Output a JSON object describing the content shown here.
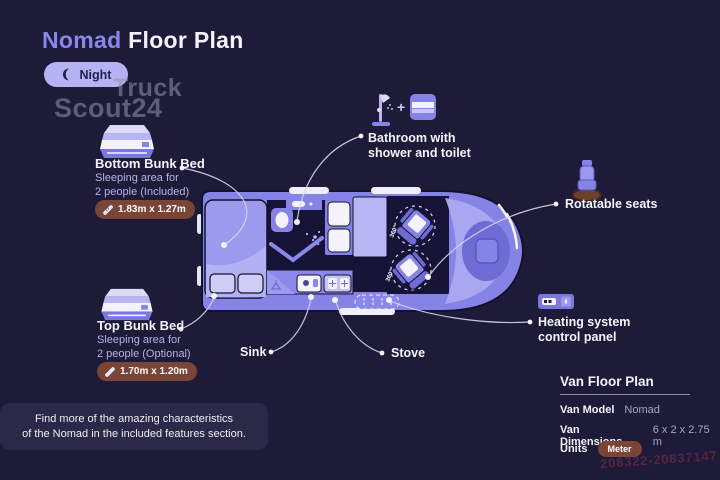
{
  "page": {
    "title_accent": "Nomad",
    "title_rest": "Floor Plan"
  },
  "mode_toggle": {
    "label": "Night"
  },
  "brand_watermark": {
    "line1": "Truck",
    "line2": "Scout24"
  },
  "callouts": {
    "bottom_bunk": {
      "title": "Bottom Bunk Bed",
      "subtitle1": "Sleeping area for",
      "subtitle2": "2 people (Included)",
      "dimensions": "1.83m x 1.27m"
    },
    "top_bunk": {
      "title": "Top Bunk Bed",
      "subtitle1": "Sleeping area for",
      "subtitle2": "2 people (Optional)",
      "dimensions": "1.70m x 1.20m"
    },
    "bathroom": {
      "label1": "Bathroom with",
      "label2": "shower and toilet",
      "plus": "+"
    },
    "rotatable_seats": {
      "label": "Rotatable seats"
    },
    "heating": {
      "label1": "Heating system",
      "label2": "control panel"
    },
    "sink": {
      "label": "Sink"
    },
    "stove": {
      "label": "Stove"
    }
  },
  "van_diagram": {
    "rotation_label": "360°"
  },
  "footer_note": {
    "line1": "Find more of the amazing characteristics",
    "line2": "of the Nomad in the included features section."
  },
  "spec_panel": {
    "title": "Van Floor Plan",
    "rows": [
      {
        "label": "Van Model",
        "value": "Nomad"
      },
      {
        "label": "Van Dimensions",
        "value": "6 x 2 x 2.75 m"
      },
      {
        "label": "Units",
        "value": "Meter"
      }
    ]
  },
  "watermark_id": "208322-20837147",
  "colors": {
    "background": "#1d1b38",
    "accent_purple": "#8583e6",
    "light_purple": "#b7b5f3",
    "pill_purple": "#b5b3f4",
    "badge_brown": "#7a4437",
    "dark_interior": "#161336",
    "text_primary": "#f4f3fc",
    "text_muted": "#b6b3ea",
    "watermark_red": "#5e2744"
  }
}
